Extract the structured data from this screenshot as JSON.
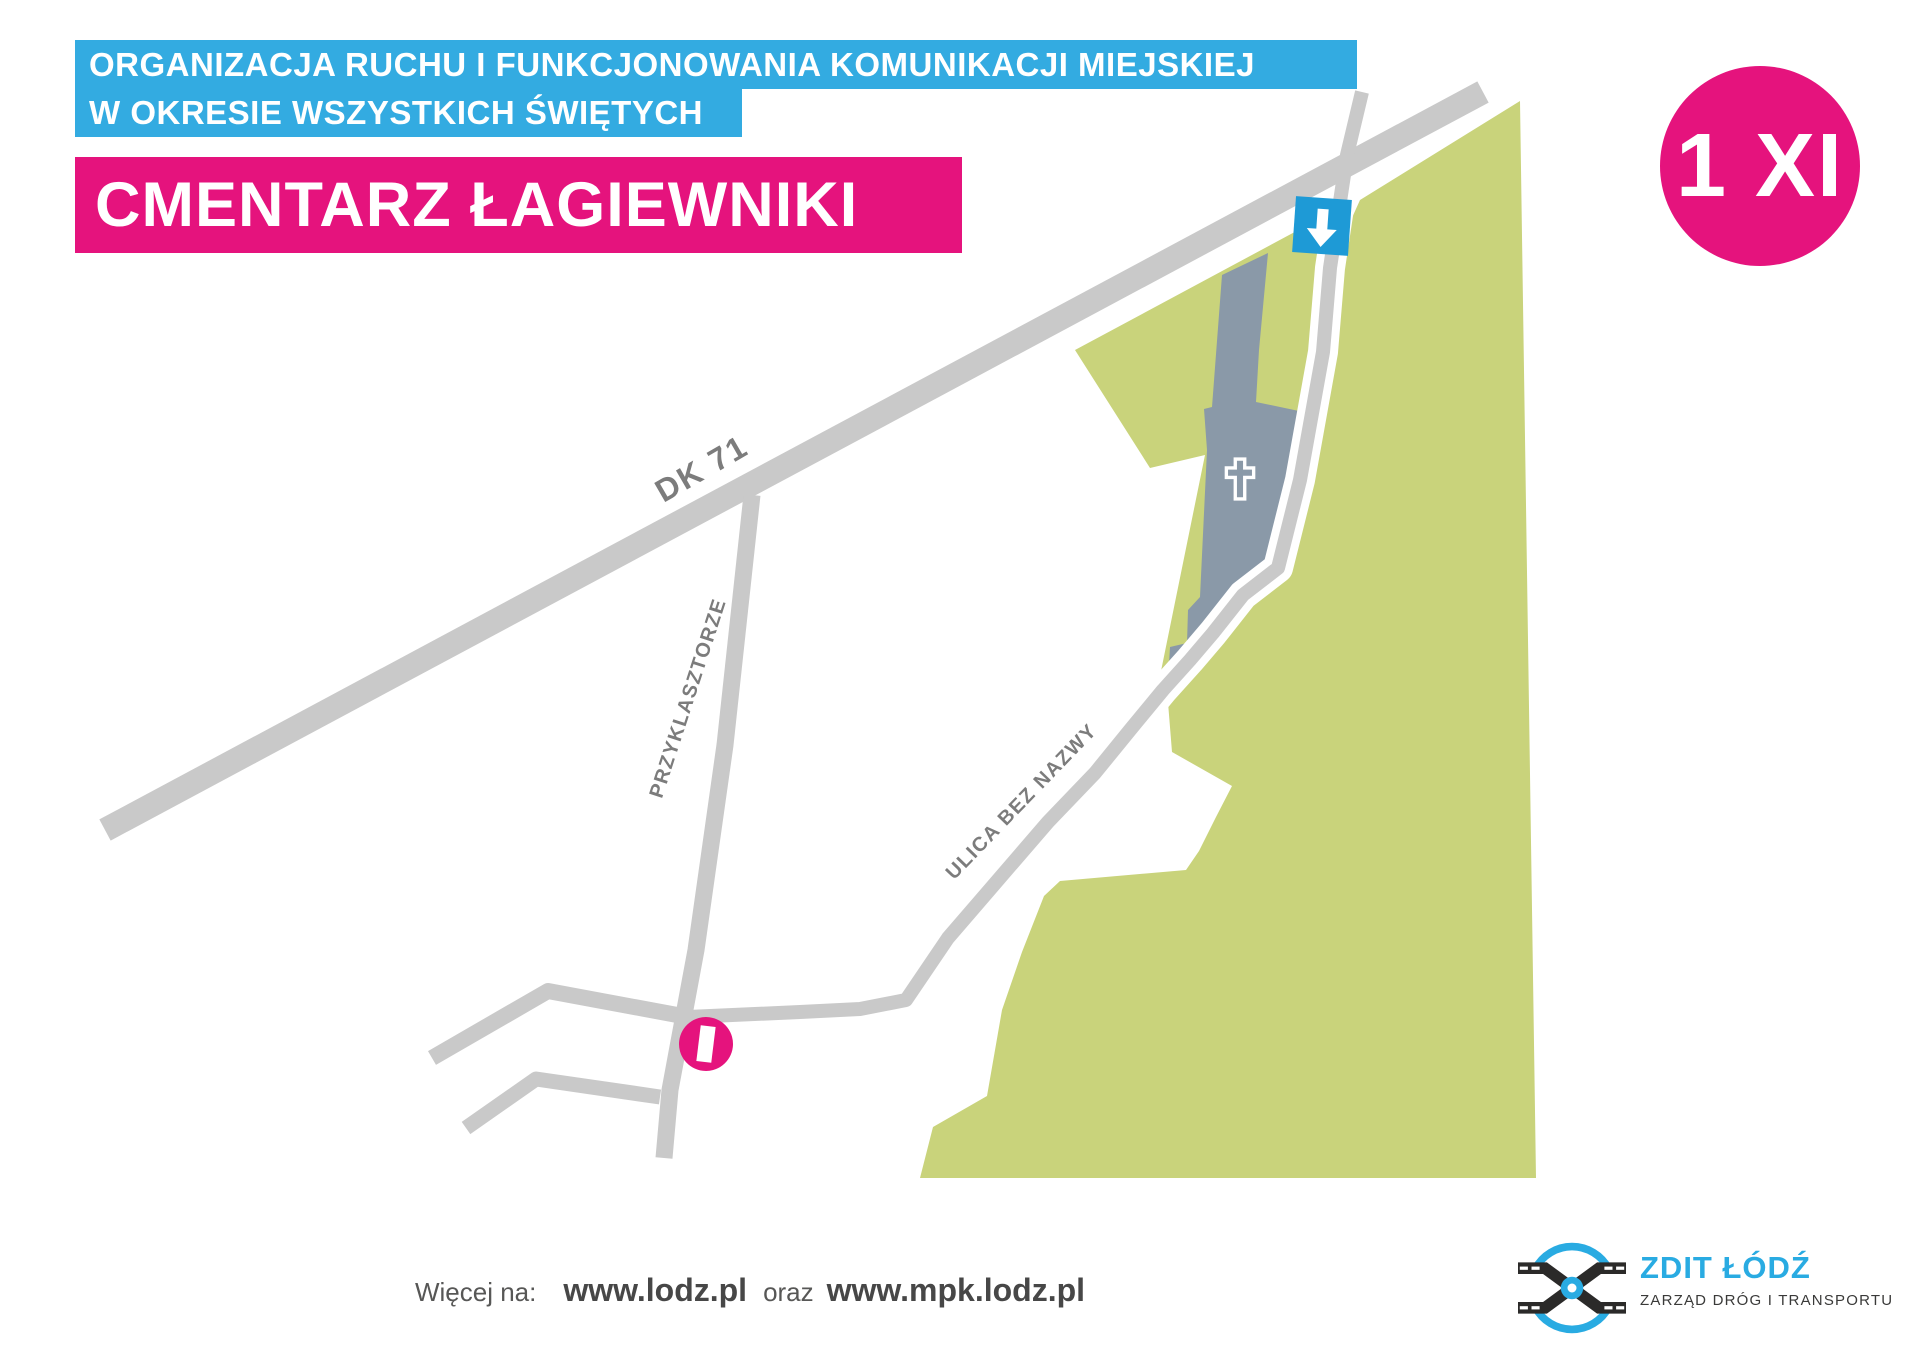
{
  "header": {
    "topline1": "ORGANIZACJA RUCHU I FUNKCJONOWANIA KOMUNIKACJI MIEJSKIEJ",
    "topline2": "W OKRESIE WSZYSTKICH ŚWIĘTYCH",
    "title": "CMENTARZ ŁAGIEWNIKI",
    "date_badge": "1 XI"
  },
  "map": {
    "labels": {
      "dk71": "DK 71",
      "przyklasztorze": "PRZYKLASZTORZE",
      "ulica_bez_nazwy": "ULICA BEZ NAZWY"
    },
    "markers": {
      "entrance_arrow": "down-arrow on road at cemetery entrance",
      "info_point": "I",
      "cemetery_cross": "cross"
    }
  },
  "footer": {
    "more_label": "Więcej na:",
    "site1": "www.lodz.pl",
    "conjunction": "oraz",
    "site2": "www.mpk.lodz.pl"
  },
  "logo": {
    "name": "ZDIT ŁÓDŹ",
    "subtitle": "ZARZĄD DRÓG I TRANSPORTU"
  },
  "colors": {
    "accent_blue": "#33ABE1",
    "accent_pink": "#E5137D",
    "map_green": "#C9D37B",
    "cemetery_gray": "#8A99A8",
    "road_gray": "#C9C9C9",
    "label_gray": "#7C7C7C",
    "logo_blue": "#29ABE2",
    "logo_dark": "#2B2A29",
    "footer_gray": "#575756",
    "arrow_box_blue": "#1E9AD6"
  }
}
